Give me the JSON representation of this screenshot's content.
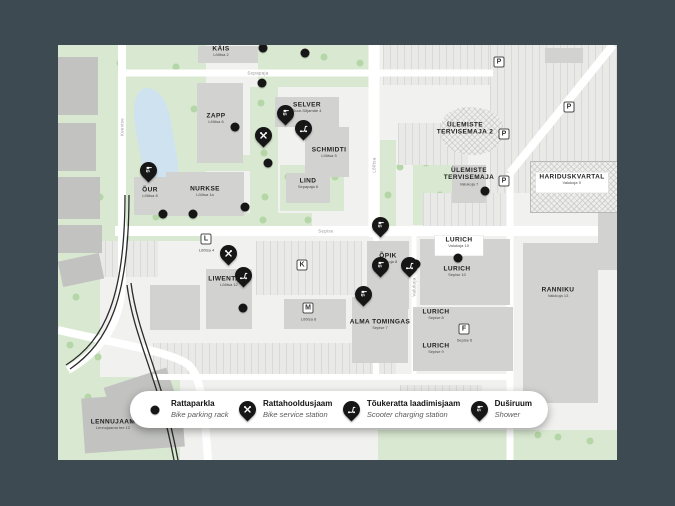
{
  "colors": {
    "page_bg": "#3e4a51",
    "map_bg": "#f1f1ef",
    "building": "#d2d2d1",
    "building_dark": "#c2c3c1",
    "green": "#d9e9d1",
    "water": "#cfe2f0",
    "road": "#ffffff",
    "railway": "#2b2b2b",
    "marker": "#161616"
  },
  "map": {
    "labels": [
      {
        "name": "KÄIS",
        "sub": "Lõõtsa 2",
        "x": 163,
        "y": 9
      },
      {
        "name": "ZAPP",
        "sub": "Lõõtsa 6",
        "x": 158,
        "y": 76
      },
      {
        "name": "SELVER",
        "sub": "Suur-Sõjamäe 4",
        "x": 249,
        "y": 65
      },
      {
        "name": "SCHMIDTI",
        "sub": "Lõõtsa 5",
        "x": 271,
        "y": 110
      },
      {
        "name": "LIND",
        "sub": "Sepapaja 6",
        "x": 250,
        "y": 141
      },
      {
        "name": "NURKSE",
        "sub": "Lõõtsa 1a",
        "x": 147,
        "y": 149
      },
      {
        "name": "ÕUR",
        "sub": "Lõõtsa 8",
        "x": 92,
        "y": 150
      },
      {
        "name": "LIWENTAAL",
        "sub": "Lõõtsa 12",
        "x": 171,
        "y": 239
      },
      {
        "name": "ÕPIK",
        "sub": "Valukoja 8",
        "x": 330,
        "y": 216
      },
      {
        "name": "LURICH",
        "sub": "Valukoja 10",
        "x": 401,
        "y": 201,
        "boxed": true
      },
      {
        "name": "LURICH",
        "sub": "Sepise 10",
        "x": 399,
        "y": 229
      },
      {
        "name": "LURICH",
        "sub": "Sepise 8",
        "x": 378,
        "y": 272
      },
      {
        "name": "LURICH",
        "sub": "Sepise 9",
        "x": 378,
        "y": 306
      },
      {
        "name": "ALMA TOMINGAS",
        "sub": "Sepise 7",
        "x": 322,
        "y": 282
      },
      {
        "name": "RANNIKU",
        "sub": "Valukoja 13",
        "x": 500,
        "y": 250
      },
      {
        "name": "ÜLEMISTE TERVISEMAJA",
        "sub": "Valukoja 7",
        "x": 411,
        "y": 134
      },
      {
        "name": "ÜLEMISTE TERVISEMAJA 2",
        "sub": "",
        "x": 407,
        "y": 84
      },
      {
        "name": "HARIDUSKVARTAL",
        "sub": "Valukoja 9",
        "x": 514,
        "y": 138,
        "boxed": true
      },
      {
        "name": "LENNUJAAM",
        "sub": "Lennujaama tee 12",
        "x": 55,
        "y": 382
      }
    ],
    "streets": [
      {
        "name": "Sepapaja",
        "x": 200,
        "y": 28,
        "vertical": false
      },
      {
        "name": "Lõõtsa",
        "x": 316,
        "y": 120,
        "vertical": true
      },
      {
        "name": "Sepise",
        "x": 268,
        "y": 186,
        "vertical": false
      },
      {
        "name": "Valukoja",
        "x": 356,
        "y": 242,
        "vertical": true
      },
      {
        "name": "Keevise",
        "x": 64,
        "y": 82,
        "vertical": true
      }
    ],
    "badges": [
      {
        "letter": "P",
        "x": 441,
        "y": 17
      },
      {
        "letter": "P",
        "x": 511,
        "y": 62
      },
      {
        "letter": "P",
        "x": 446,
        "y": 89
      },
      {
        "letter": "P",
        "x": 446,
        "y": 136
      },
      {
        "letter": "L",
        "x": 148,
        "y": 194,
        "sub": "Lõõtsa 4"
      },
      {
        "letter": "K",
        "x": 244,
        "y": 220
      },
      {
        "letter": "M",
        "x": 250,
        "y": 263,
        "sub": "Lõõtsa 8"
      },
      {
        "letter": "F",
        "x": 406,
        "y": 284,
        "sub": "Sepise 6"
      }
    ],
    "pins": [
      {
        "type": "shower",
        "x": 90,
        "y": 138
      },
      {
        "type": "shower",
        "x": 227,
        "y": 81
      },
      {
        "type": "shower",
        "x": 322,
        "y": 193
      },
      {
        "type": "shower",
        "x": 322,
        "y": 233
      },
      {
        "type": "shower",
        "x": 305,
        "y": 262
      },
      {
        "type": "service",
        "x": 205,
        "y": 103
      },
      {
        "type": "service",
        "x": 170,
        "y": 221
      },
      {
        "type": "scooter",
        "x": 245,
        "y": 96
      },
      {
        "type": "scooter",
        "x": 185,
        "y": 243
      },
      {
        "type": "scooter",
        "x": 351,
        "y": 233
      }
    ],
    "dots": [
      [
        205,
        3
      ],
      [
        247,
        8
      ],
      [
        204,
        38
      ],
      [
        177,
        82
      ],
      [
        210,
        118
      ],
      [
        105,
        169
      ],
      [
        135,
        169
      ],
      [
        187,
        162
      ],
      [
        358,
        219
      ],
      [
        400,
        213
      ],
      [
        427,
        146
      ],
      [
        187,
        228
      ],
      [
        185,
        263
      ]
    ]
  },
  "legend": {
    "items": [
      {
        "icon": "parking-dot",
        "title": "Rattaparkla",
        "subtitle": "Bike parking rack"
      },
      {
        "icon": "service-pin",
        "title": "Rattahooldusjaam",
        "subtitle": "Bike service station"
      },
      {
        "icon": "scooter-pin",
        "title": "Tõukeratta laadimisjaam",
        "subtitle": "Scooter charging station"
      },
      {
        "icon": "shower-pin",
        "title": "Duširuum",
        "subtitle": "Shower"
      }
    ]
  }
}
